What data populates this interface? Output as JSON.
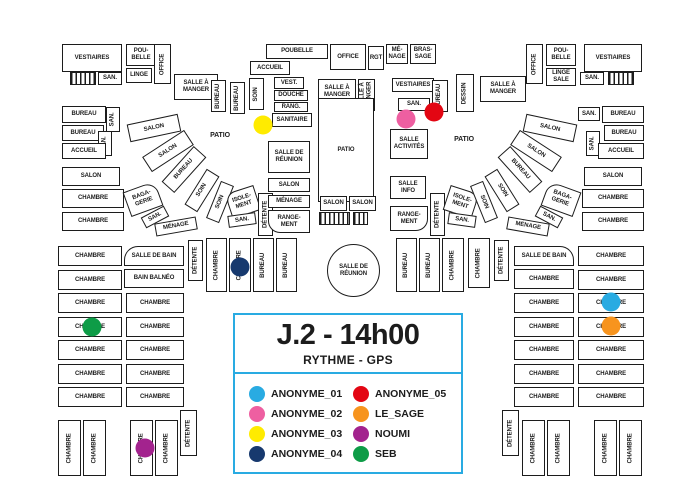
{
  "legend": {
    "title": "J.2 - 14h00",
    "subtitle": "RYTHME - GPS",
    "border_color": "#29ABE2",
    "box": {
      "x": 233,
      "y": 313,
      "w": 230,
      "h": 161
    },
    "entries": [
      {
        "name": "ANONYME_01",
        "color": "#29ABE2"
      },
      {
        "name": "ANONYME_02",
        "color": "#EE5FA1"
      },
      {
        "name": "ANONYME_03",
        "color": "#FFEB00"
      },
      {
        "name": "ANONYME_04",
        "color": "#17396E"
      },
      {
        "name": "ANONYME_05",
        "color": "#E30613"
      },
      {
        "name": "LE_SAGE",
        "color": "#F7941E"
      },
      {
        "name": "NOUMI",
        "color": "#A3238E"
      },
      {
        "name": "SEB",
        "color": "#0E9C47"
      }
    ]
  },
  "wall_color": "#1c1c1c",
  "markers": [
    {
      "person": "ANONYME_03",
      "x": 263,
      "y": 125
    },
    {
      "person": "ANONYME_02",
      "x": 406,
      "y": 119
    },
    {
      "person": "ANONYME_05",
      "x": 434,
      "y": 112
    },
    {
      "person": "ANONYME_04",
      "x": 240,
      "y": 267
    },
    {
      "person": "ANONYME_01",
      "x": 611,
      "y": 302
    },
    {
      "person": "LE_SAGE",
      "x": 611,
      "y": 326
    },
    {
      "person": "SEB",
      "x": 92,
      "y": 327
    },
    {
      "person": "NOUMI",
      "x": 145,
      "y": 448
    }
  ],
  "stairs": [
    {
      "x": 70,
      "y": 72,
      "w": 26,
      "h": 13
    },
    {
      "x": 608,
      "y": 72,
      "w": 26,
      "h": 13
    },
    {
      "x": 319,
      "y": 212,
      "w": 31,
      "h": 13
    },
    {
      "x": 353,
      "y": 212,
      "w": 15,
      "h": 13
    }
  ],
  "rooms": [
    {
      "l": "VESTIAIRES",
      "x": 62,
      "y": 44,
      "w": 60,
      "h": 28
    },
    {
      "l": "SAN.",
      "x": 98,
      "y": 72,
      "w": 24,
      "h": 13
    },
    {
      "l": "POU-\nBELLE",
      "x": 126,
      "y": 44,
      "w": 30,
      "h": 22
    },
    {
      "l": "LINGE",
      "x": 126,
      "y": 68,
      "w": 26,
      "h": 15
    },
    {
      "l": "OFFICE",
      "x": 154,
      "y": 44,
      "w": 17,
      "h": 40,
      "v": 1
    },
    {
      "l": "SALLE À\nMANGER",
      "x": 174,
      "y": 74,
      "w": 44,
      "h": 26
    },
    {
      "l": "BUREAU",
      "x": 211,
      "y": 80,
      "w": 15,
      "h": 32,
      "v": 1
    },
    {
      "l": "BUREAU",
      "x": 230,
      "y": 82,
      "w": 15,
      "h": 32,
      "v": 1
    },
    {
      "l": "SOIN",
      "x": 249,
      "y": 78,
      "w": 15,
      "h": 32,
      "v": 1
    },
    {
      "l": "ACCUEIL",
      "x": 250,
      "y": 61,
      "w": 40,
      "h": 14
    },
    {
      "l": "POUBELLE",
      "x": 266,
      "y": 44,
      "w": 62,
      "h": 15
    },
    {
      "l": "OFFICE",
      "x": 330,
      "y": 44,
      "w": 36,
      "h": 26
    },
    {
      "l": "RGT",
      "x": 368,
      "y": 46,
      "w": 16,
      "h": 24
    },
    {
      "l": "MÉ-\nNAGE",
      "x": 386,
      "y": 44,
      "w": 22,
      "h": 20
    },
    {
      "l": "BRAS-\nSAGE",
      "x": 410,
      "y": 44,
      "w": 26,
      "h": 20
    },
    {
      "l": "VEST.",
      "x": 274,
      "y": 77,
      "w": 30,
      "h": 12
    },
    {
      "l": "DOUCHE",
      "x": 274,
      "y": 90,
      "w": 34,
      "h": 11
    },
    {
      "l": "RANG.",
      "x": 274,
      "y": 102,
      "w": 34,
      "h": 10
    },
    {
      "l": "SANITAIRE",
      "x": 272,
      "y": 113,
      "w": 40,
      "h": 14
    },
    {
      "l": "SALLE À\nMANGER",
      "x": 318,
      "y": 79,
      "w": 38,
      "h": 25
    },
    {
      "l": "SALLE À\nMANGER",
      "x": 358,
      "y": 79,
      "w": 17,
      "h": 32,
      "v": 1
    },
    {
      "l": "VESTIAIRES",
      "x": 392,
      "y": 78,
      "w": 42,
      "h": 14
    },
    {
      "l": "SAN.",
      "x": 398,
      "y": 98,
      "w": 32,
      "h": 13
    },
    {
      "l": "BUREAU",
      "x": 432,
      "y": 80,
      "w": 16,
      "h": 32,
      "v": 1
    },
    {
      "l": "DESSIN",
      "x": 456,
      "y": 74,
      "w": 18,
      "h": 38,
      "v": 1
    },
    {
      "l": "SALLE À\nMANGER",
      "x": 480,
      "y": 76,
      "w": 46,
      "h": 26
    },
    {
      "l": "OFFICE",
      "x": 526,
      "y": 44,
      "w": 17,
      "h": 40,
      "v": 1
    },
    {
      "l": "POU-\nBELLE",
      "x": 546,
      "y": 44,
      "w": 30,
      "h": 22
    },
    {
      "l": "LINGE\nSALE",
      "x": 546,
      "y": 68,
      "w": 30,
      "h": 18
    },
    {
      "l": "VESTIAIRES",
      "x": 584,
      "y": 44,
      "w": 58,
      "h": 28
    },
    {
      "l": "SAN.",
      "x": 580,
      "y": 72,
      "w": 24,
      "h": 13
    },
    {
      "l": "BUREAU",
      "x": 62,
      "y": 106,
      "w": 44,
      "h": 17
    },
    {
      "l": "SAN.",
      "x": 106,
      "y": 107,
      "w": 14,
      "h": 25,
      "v": 1
    },
    {
      "l": "BUREAU",
      "x": 62,
      "y": 125,
      "w": 42,
      "h": 16
    },
    {
      "l": "SAN.",
      "x": 98,
      "y": 131,
      "w": 14,
      "h": 25,
      "v": 1
    },
    {
      "l": "ACCUEIL",
      "x": 62,
      "y": 143,
      "w": 44,
      "h": 16
    },
    {
      "l": "SALON",
      "x": 62,
      "y": 167,
      "w": 58,
      "h": 19
    },
    {
      "l": "CHAMBRE",
      "x": 62,
      "y": 189,
      "w": 62,
      "h": 19
    },
    {
      "l": "CHAMBRE",
      "x": 62,
      "y": 212,
      "w": 62,
      "h": 19
    },
    {
      "l": "SAN.",
      "x": 578,
      "y": 107,
      "w": 22,
      "h": 14
    },
    {
      "l": "BUREAU",
      "x": 602,
      "y": 106,
      "w": 42,
      "h": 17
    },
    {
      "l": "BUREAU",
      "x": 604,
      "y": 125,
      "w": 40,
      "h": 16
    },
    {
      "l": "SAN.",
      "x": 586,
      "y": 131,
      "w": 14,
      "h": 25,
      "v": 1
    },
    {
      "l": "ACCUEIL",
      "x": 598,
      "y": 143,
      "w": 46,
      "h": 16
    },
    {
      "l": "SALON",
      "x": 584,
      "y": 167,
      "w": 58,
      "h": 19
    },
    {
      "l": "CHAMBRE",
      "x": 582,
      "y": 189,
      "w": 62,
      "h": 19
    },
    {
      "l": "CHAMBRE",
      "x": 582,
      "y": 212,
      "w": 62,
      "h": 19
    },
    {
      "l": "SALON",
      "x": 128,
      "y": 119,
      "w": 52,
      "h": 18,
      "rot": -12
    },
    {
      "l": "SALON",
      "x": 143,
      "y": 142,
      "w": 50,
      "h": 18,
      "rot": -33
    },
    {
      "l": "BUREAU",
      "x": 160,
      "y": 161,
      "w": 48,
      "h": 17,
      "rot": -48
    },
    {
      "l": "SOIN",
      "x": 181,
      "y": 183,
      "w": 42,
      "h": 15,
      "rot": -58
    },
    {
      "l": "SOIN",
      "x": 200,
      "y": 195,
      "w": 40,
      "h": 14,
      "rot": -68
    },
    {
      "l": "ISOLE-\nMENT",
      "x": 228,
      "y": 189,
      "w": 30,
      "h": 26,
      "rot": -18,
      "rad": "10px 0 0 0"
    },
    {
      "l": "SAN.",
      "x": 228,
      "y": 214,
      "w": 28,
      "h": 12,
      "rot": -8
    },
    {
      "l": "DÉTENTE",
      "x": 258,
      "y": 193,
      "w": 15,
      "h": 43,
      "v": 1
    },
    {
      "l": "BAGA-\nGERIE",
      "x": 126,
      "y": 186,
      "w": 34,
      "h": 26,
      "rot": -20,
      "rad": "0 12px 0 0"
    },
    {
      "l": "SAN.",
      "x": 142,
      "y": 211,
      "w": 26,
      "h": 12,
      "rot": -28
    },
    {
      "l": "MÉNAGE",
      "x": 155,
      "y": 220,
      "w": 42,
      "h": 13,
      "rot": -10
    },
    {
      "l": "PATIO",
      "x": 196,
      "y": 128,
      "w": 48,
      "h": 16,
      "nb": 1
    },
    {
      "l": "SALLE DE\nRÉUNION",
      "x": 268,
      "y": 141,
      "w": 42,
      "h": 32
    },
    {
      "l": "SALON",
      "x": 268,
      "y": 178,
      "w": 42,
      "h": 14
    },
    {
      "l": "MÉNAGE",
      "x": 268,
      "y": 195,
      "w": 42,
      "h": 13
    },
    {
      "l": "RANGE-\nMENT",
      "x": 268,
      "y": 210,
      "w": 42,
      "h": 23,
      "rad": "0 0 0 12px"
    },
    {
      "l": "PATIO",
      "x": 318,
      "y": 98,
      "w": 56,
      "h": 104
    },
    {
      "l": "SALON",
      "x": 320,
      "y": 196,
      "w": 27,
      "h": 15
    },
    {
      "l": "SALON",
      "x": 349,
      "y": 196,
      "w": 27,
      "h": 15
    },
    {
      "l": "SALLE DE\nRÉUNION",
      "x": 327,
      "y": 244,
      "w": 53,
      "h": 53,
      "rad": "50%"
    },
    {
      "l": "SALLE\nACTIVITÉS",
      "x": 390,
      "y": 129,
      "w": 38,
      "h": 30
    },
    {
      "l": "SALLE\nINFO",
      "x": 390,
      "y": 176,
      "w": 36,
      "h": 23
    },
    {
      "l": "RANGE-\nMENT",
      "x": 390,
      "y": 206,
      "w": 38,
      "h": 25,
      "rad": "0 0 12px 0"
    },
    {
      "l": "DÉTENTE",
      "x": 430,
      "y": 193,
      "w": 15,
      "h": 43,
      "v": 1
    },
    {
      "l": "ISOLE-\nMENT",
      "x": 446,
      "y": 189,
      "w": 30,
      "h": 26,
      "rot": 18,
      "rad": "0 10px 0 0"
    },
    {
      "l": "SAN.",
      "x": 448,
      "y": 214,
      "w": 28,
      "h": 12,
      "rot": 8
    },
    {
      "l": "SOIN",
      "x": 464,
      "y": 195,
      "w": 40,
      "h": 14,
      "rot": 68
    },
    {
      "l": "SOIN",
      "x": 481,
      "y": 183,
      "w": 42,
      "h": 15,
      "rot": 58
    },
    {
      "l": "BUREAU",
      "x": 496,
      "y": 161,
      "w": 48,
      "h": 17,
      "rot": 48
    },
    {
      "l": "SALON",
      "x": 511,
      "y": 142,
      "w": 50,
      "h": 18,
      "rot": 33
    },
    {
      "l": "SALON",
      "x": 524,
      "y": 119,
      "w": 52,
      "h": 18,
      "rot": 12
    },
    {
      "l": "BAGA-\nGERIE",
      "x": 544,
      "y": 186,
      "w": 34,
      "h": 26,
      "rot": 20,
      "rad": "12px 0 0 0"
    },
    {
      "l": "SAN.",
      "x": 536,
      "y": 211,
      "w": 26,
      "h": 12,
      "rot": 28
    },
    {
      "l": "MÉNAGE",
      "x": 507,
      "y": 220,
      "w": 42,
      "h": 13,
      "rot": 10
    },
    {
      "l": "PATIO",
      "x": 440,
      "y": 132,
      "w": 48,
      "h": 16,
      "nb": 1
    },
    {
      "l": "SALLE DE BAIN",
      "x": 124,
      "y": 246,
      "w": 60,
      "h": 20,
      "rad": "14px 0 0 0"
    },
    {
      "l": "BAIN BALNÉO",
      "x": 124,
      "y": 269,
      "w": 60,
      "h": 19
    },
    {
      "l": "DÉTENTE",
      "x": 188,
      "y": 240,
      "w": 15,
      "h": 41,
      "v": 1
    },
    {
      "l": "CHAMBRE",
      "x": 206,
      "y": 238,
      "w": 21,
      "h": 54,
      "v": 1
    },
    {
      "l": "CHAMBRE",
      "x": 229,
      "y": 238,
      "w": 22,
      "h": 54,
      "v": 1
    },
    {
      "l": "BUREAU",
      "x": 253,
      "y": 238,
      "w": 21,
      "h": 54,
      "v": 1
    },
    {
      "l": "BUREAU",
      "x": 276,
      "y": 238,
      "w": 21,
      "h": 54,
      "v": 1
    },
    {
      "l": "BUREAU",
      "x": 396,
      "y": 238,
      "w": 21,
      "h": 54,
      "v": 1
    },
    {
      "l": "BUREAU",
      "x": 419,
      "y": 238,
      "w": 21,
      "h": 54,
      "v": 1
    },
    {
      "l": "CHAMBRE",
      "x": 442,
      "y": 238,
      "w": 22,
      "h": 54,
      "v": 1
    },
    {
      "l": "CHAMBRE",
      "x": 468,
      "y": 238,
      "w": 22,
      "h": 50,
      "v": 1
    },
    {
      "l": "DÉTENTE",
      "x": 494,
      "y": 240,
      "w": 15,
      "h": 41,
      "v": 1
    },
    {
      "l": "SALLE DE BAIN",
      "x": 514,
      "y": 246,
      "w": 60,
      "h": 20,
      "rad": "0 14px 0 0"
    },
    {
      "l": "CHAMBRE",
      "x": 58,
      "y": 246,
      "w": 64,
      "h": 20
    },
    {
      "l": "CHAMBRE",
      "x": 58,
      "y": 270,
      "w": 64,
      "h": 20
    },
    {
      "l": "CHAMBRE",
      "x": 58,
      "y": 293,
      "w": 64,
      "h": 20
    },
    {
      "l": "CHAMBRE",
      "x": 58,
      "y": 317,
      "w": 64,
      "h": 20
    },
    {
      "l": "CHAMBRE",
      "x": 58,
      "y": 340,
      "w": 64,
      "h": 20
    },
    {
      "l": "CHAMBRE",
      "x": 58,
      "y": 364,
      "w": 64,
      "h": 20
    },
    {
      "l": "CHAMBRE",
      "x": 58,
      "y": 387,
      "w": 64,
      "h": 20
    },
    {
      "l": "CHAMBRE",
      "x": 126,
      "y": 293,
      "w": 58,
      "h": 20
    },
    {
      "l": "CHAMBRE",
      "x": 126,
      "y": 317,
      "w": 58,
      "h": 20
    },
    {
      "l": "CHAMBRE",
      "x": 126,
      "y": 340,
      "w": 58,
      "h": 20
    },
    {
      "l": "CHAMBRE",
      "x": 126,
      "y": 364,
      "w": 58,
      "h": 20
    },
    {
      "l": "CHAMBRE",
      "x": 126,
      "y": 387,
      "w": 58,
      "h": 20
    },
    {
      "l": "CHAMBRE",
      "x": 514,
      "y": 269,
      "w": 60,
      "h": 20
    },
    {
      "l": "CHAMBRE",
      "x": 514,
      "y": 293,
      "w": 60,
      "h": 20
    },
    {
      "l": "CHAMBRE",
      "x": 514,
      "y": 317,
      "w": 60,
      "h": 20
    },
    {
      "l": "CHAMBRE",
      "x": 514,
      "y": 340,
      "w": 60,
      "h": 20
    },
    {
      "l": "CHAMBRE",
      "x": 514,
      "y": 364,
      "w": 60,
      "h": 20
    },
    {
      "l": "CHAMBRE",
      "x": 514,
      "y": 387,
      "w": 60,
      "h": 20
    },
    {
      "l": "CHAMBRE",
      "x": 578,
      "y": 246,
      "w": 66,
      "h": 20
    },
    {
      "l": "CHAMBRE",
      "x": 578,
      "y": 270,
      "w": 66,
      "h": 20
    },
    {
      "l": "CHAMBRE",
      "x": 578,
      "y": 293,
      "w": 66,
      "h": 20
    },
    {
      "l": "CHAMBRE",
      "x": 578,
      "y": 317,
      "w": 66,
      "h": 20
    },
    {
      "l": "CHAMBRE",
      "x": 578,
      "y": 340,
      "w": 66,
      "h": 20
    },
    {
      "l": "CHAMBRE",
      "x": 578,
      "y": 364,
      "w": 66,
      "h": 20
    },
    {
      "l": "CHAMBRE",
      "x": 578,
      "y": 387,
      "w": 66,
      "h": 20
    },
    {
      "l": "CHAMBRE",
      "x": 58,
      "y": 420,
      "w": 23,
      "h": 56,
      "v": 1
    },
    {
      "l": "CHAMBRE",
      "x": 83,
      "y": 420,
      "w": 23,
      "h": 56,
      "v": 1
    },
    {
      "l": "CHAMBRE",
      "x": 130,
      "y": 420,
      "w": 23,
      "h": 56,
      "v": 1
    },
    {
      "l": "CHAMBRE",
      "x": 155,
      "y": 420,
      "w": 23,
      "h": 56,
      "v": 1
    },
    {
      "l": "DÉTENTE",
      "x": 180,
      "y": 410,
      "w": 17,
      "h": 46,
      "v": 1
    },
    {
      "l": "DÉTENTE",
      "x": 502,
      "y": 410,
      "w": 17,
      "h": 46,
      "v": 1
    },
    {
      "l": "CHAMBRE",
      "x": 522,
      "y": 420,
      "w": 23,
      "h": 56,
      "v": 1
    },
    {
      "l": "CHAMBRE",
      "x": 547,
      "y": 420,
      "w": 23,
      "h": 56,
      "v": 1
    },
    {
      "l": "CHAMBRE",
      "x": 594,
      "y": 420,
      "w": 23,
      "h": 56,
      "v": 1
    },
    {
      "l": "CHAMBRE",
      "x": 619,
      "y": 420,
      "w": 23,
      "h": 56,
      "v": 1
    }
  ]
}
